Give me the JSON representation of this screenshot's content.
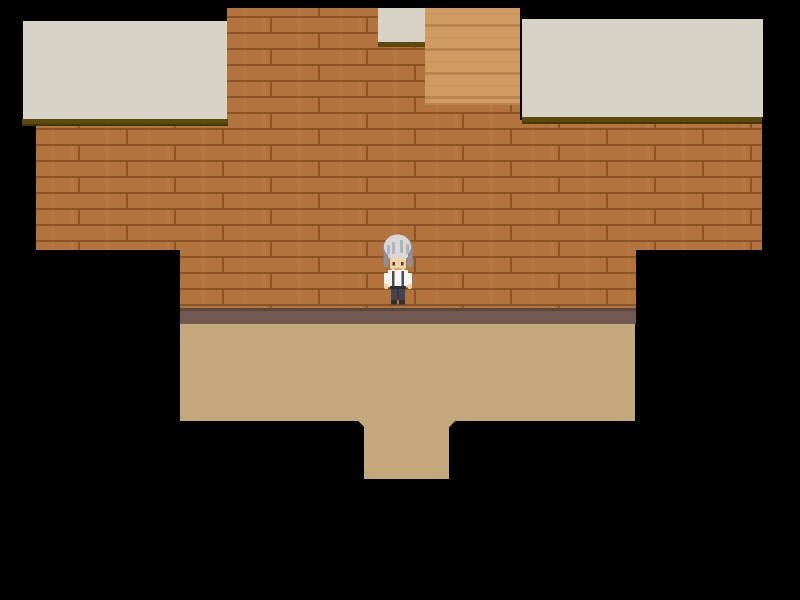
{
  "meta": {
    "type": "game-screenshot",
    "genre": "top-down pixel RPG room interior",
    "description": "Room with wooden plank walls, a staircase opening at the top, cream roof/ceiling panels, a beige floor with a doorway step at the bottom, and a single character standing at center"
  },
  "viewport": {
    "width": 800,
    "height": 600
  },
  "colors": {
    "background": "#000000",
    "wall_plank": "#b2733d",
    "wall_plank_light": "#c08352",
    "wall_seam": "#8a5526",
    "stairs_base": "#d09b63",
    "stairs_shade": "#b9854e",
    "roof_panel": "#d7d4c7",
    "roof_eave": "#5a4a0c",
    "roof_eave_dark": "#42360a",
    "wall_base_trim": "#6f5951",
    "wall_base_trim_dark": "#5a4841",
    "floor": "#c3a87b",
    "char_hair_light": "#d7d7d9",
    "char_hair_shadow": "#8e8e96",
    "char_skin": "#f2d2a0",
    "char_skin_shade": "#d9ad7e",
    "char_eye": "#4a3a30",
    "char_shirt": "#f5f5f3",
    "char_strap": "#4b4a54",
    "char_pants": "#45444f",
    "char_pants_seam": "#2e2d36",
    "char_dark": "#2f2e33"
  },
  "entities": {
    "player": {
      "name": "player-character",
      "facing": "down",
      "appearance": "silver spiky hair, white shirt with dark suspenders, dark trousers, dark shoes",
      "position_px": {
        "x": 398,
        "y": 269
      }
    }
  },
  "regions": {
    "wall": "wooden plank wall",
    "staircase": "staircase opening at top center",
    "roof_left": "cream panel top-left",
    "roof_top": "small cream panel top-center",
    "roof_right": "cream panel top-right",
    "trim": "dark baseboard strip",
    "floor": "beige floor with doorway step at bottom"
  }
}
